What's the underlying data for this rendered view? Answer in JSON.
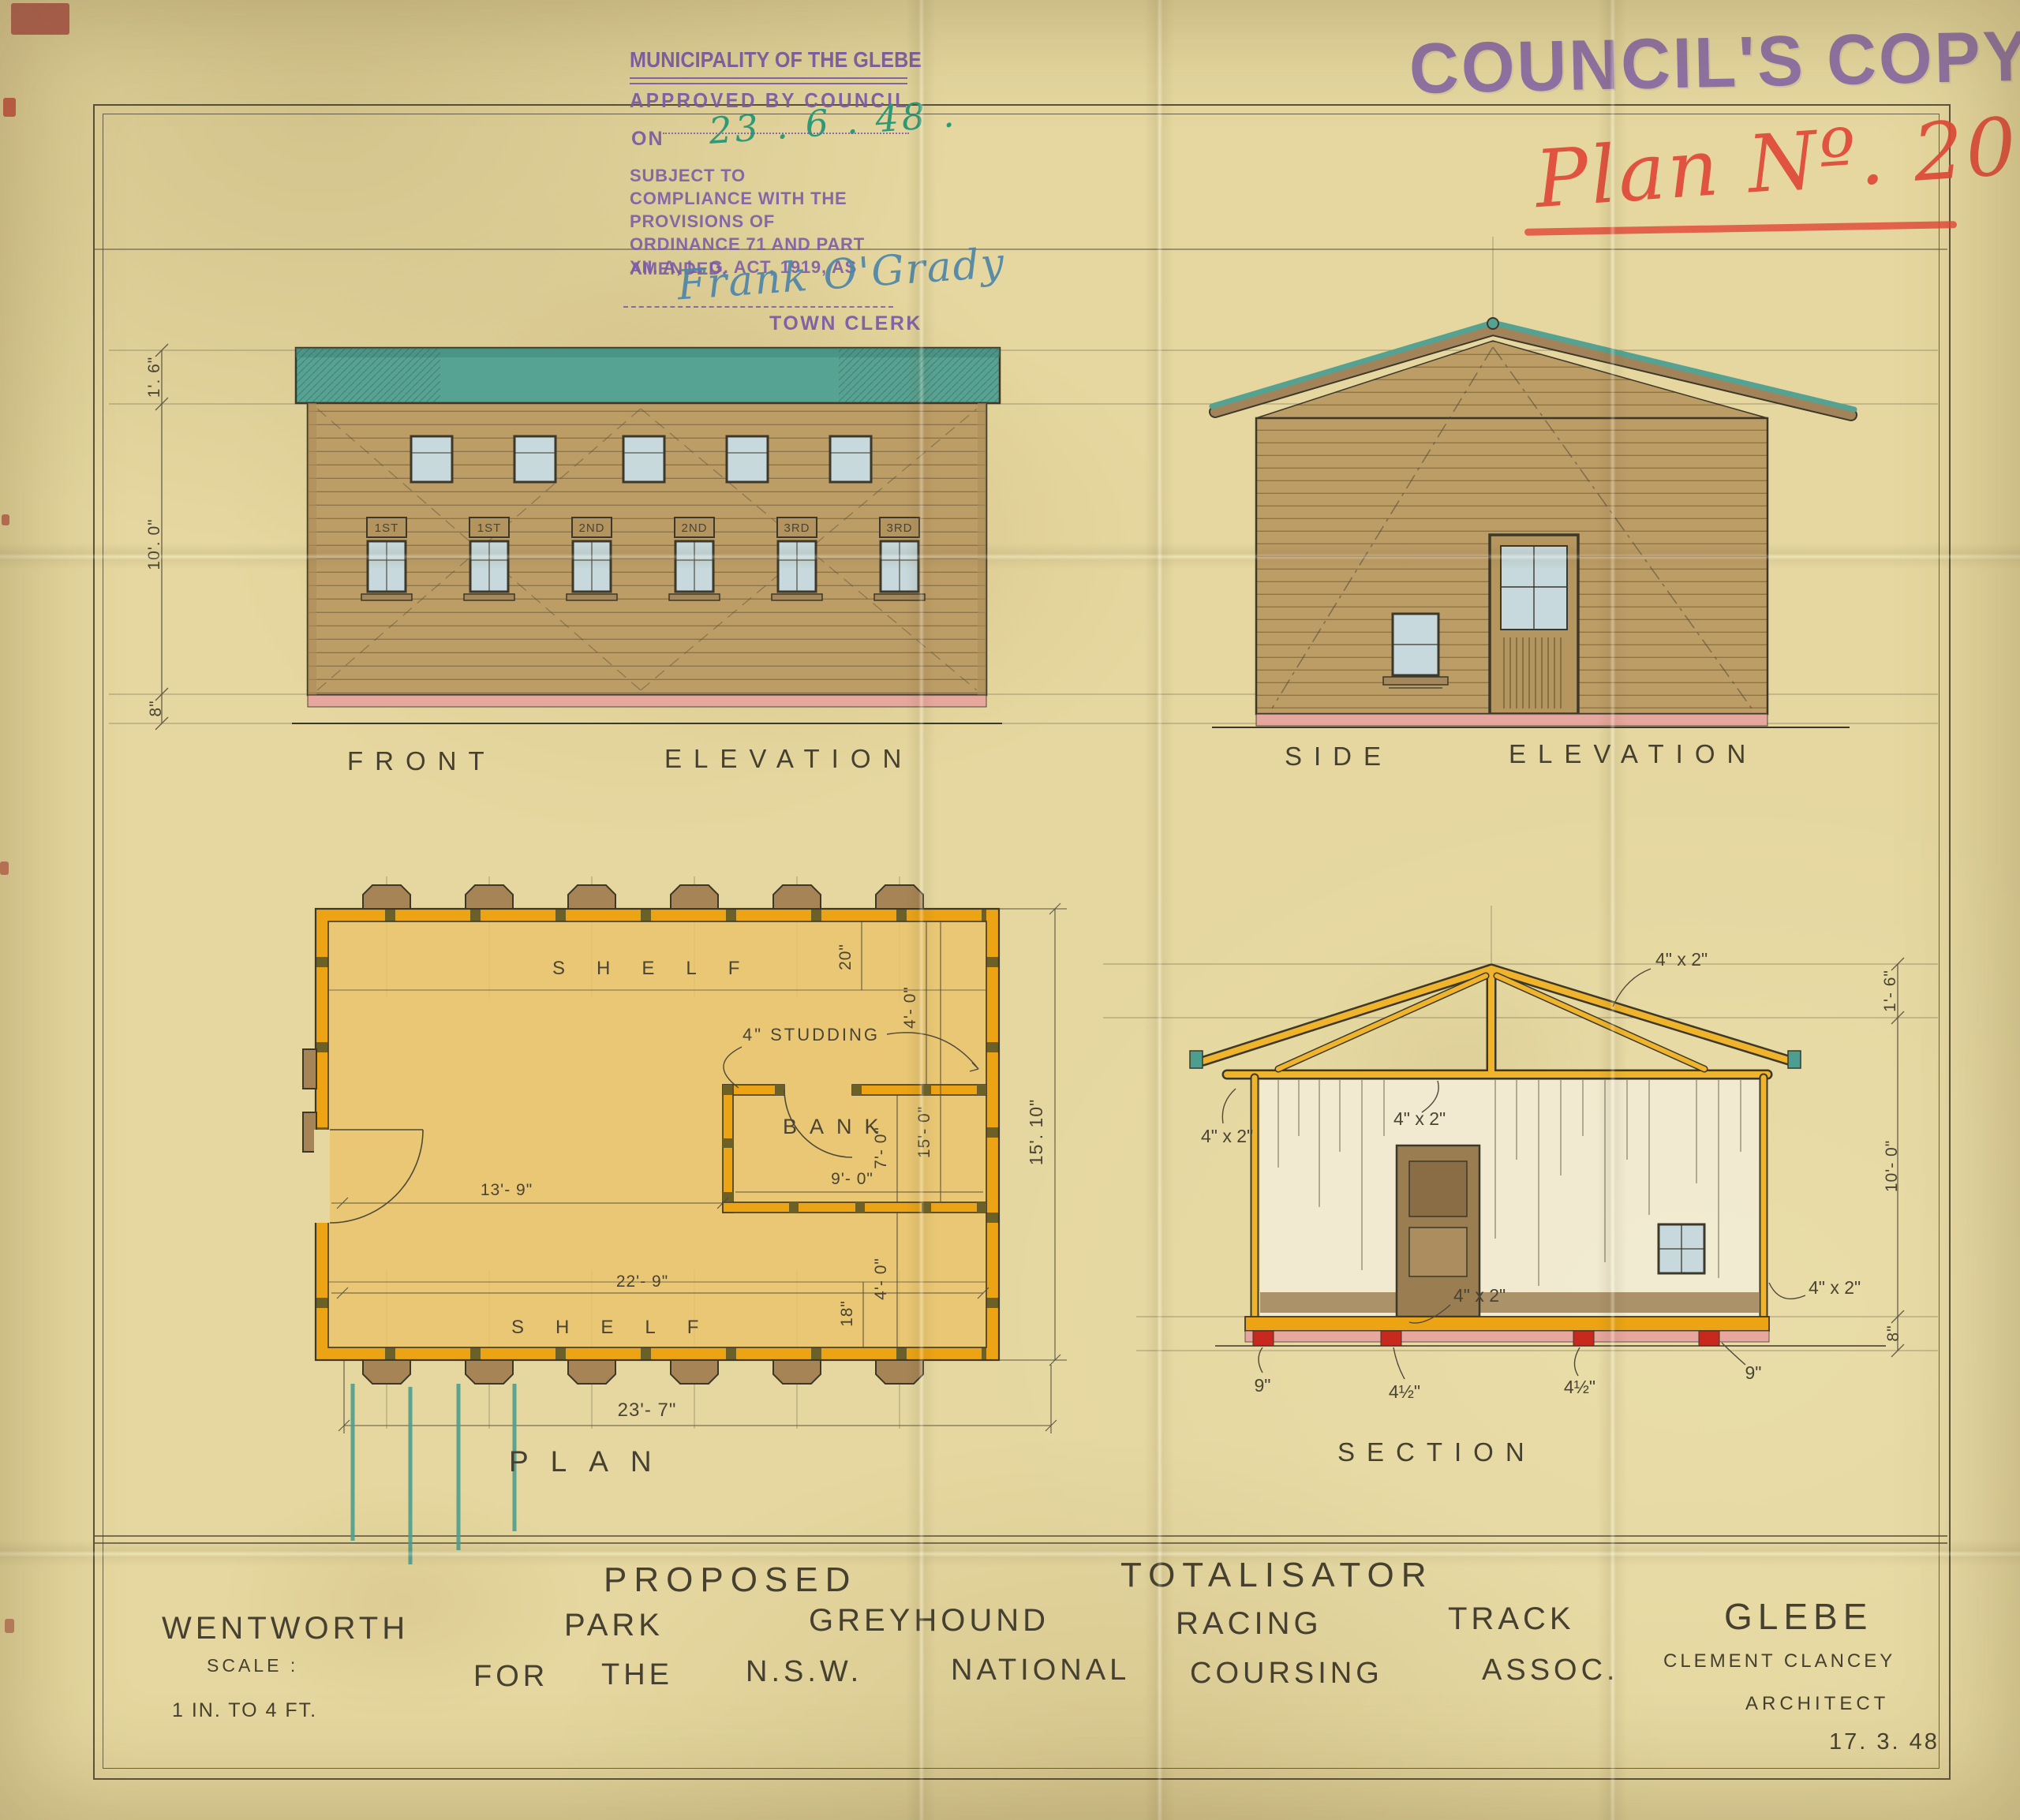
{
  "stamps": {
    "municipality": {
      "authority": "MUNICIPALITY OF THE GLEBE",
      "approved": "APPROVED BY COUNCIL",
      "on_label": "ON",
      "approval_date": "23 . 6 . 48 .",
      "conditions": "SUBJECT TO COMPLIANCE WITH THE PROVISIONS OF ORDINANCE 71 AND PART XII. A, L. G. ACT, 1919, AS",
      "amended": "AMENDED.",
      "signature": "Frank O'Grady",
      "signatory_title": "TOWN CLERK"
    },
    "councils_copy": "COUNCIL'S COPY.",
    "plan_number": "Plan Nº. 20"
  },
  "front_elevation": {
    "caption_a": "FRONT",
    "caption_b": "ELEVATION",
    "window_signs": [
      "1ST",
      "1ST",
      "2ND",
      "2ND",
      "3RD",
      "3RD"
    ],
    "dim_roof": "1'. 6\"",
    "dim_wall": "10'. 0\"",
    "dim_base": "8\""
  },
  "side_elevation": {
    "caption_a": "SIDE",
    "caption_b": "ELEVATION"
  },
  "plan": {
    "caption": "PLAN",
    "shelf_top": "SHELF",
    "shelf_bottom": "SHELF",
    "studding_note": "4\" STUDDING",
    "room_label": "BANK",
    "dim_shelf_top": "20\"",
    "dim_top_right": "4'- 0\"",
    "dim_bank_width": "9'- 0\"",
    "dim_bank_depth": "7'- 0\"",
    "dim_inner_depth": "15'- 0\"",
    "dim_bank_offset": "4'- 0\"",
    "dim_left_room": "13'- 9\"",
    "dim_inner_width": "22'- 9\"",
    "dim_shelf_bottom": "18\"",
    "dim_overall_width": "23'- 7\"",
    "dim_overall_depth": "15'. 10\""
  },
  "section": {
    "caption": "SECTION",
    "timber_note": "4\" x 2\"",
    "dim_pier_left": "9\"",
    "dim_plate_left": "4½\"",
    "dim_plate_right": "4½\"",
    "dim_pier_right": "9\"",
    "dim_roof": "1'- 6\"",
    "dim_wall": "10'- 0\"",
    "dim_base": "8\""
  },
  "title_block": {
    "row1": {
      "w1": "PROPOSED",
      "w2": "TOTALISATOR"
    },
    "row2": {
      "w1": "WENTWORTH",
      "w2": "PARK",
      "w3": "GREYHOUND",
      "w4": "RACING",
      "w5": "TRACK",
      "w6": "GLEBE"
    },
    "row3": {
      "w1": "FOR",
      "w2": "THE",
      "w3": "N.S.W.",
      "w4": "NATIONAL",
      "w5": "COURSING",
      "w6": "ASSOC."
    },
    "scale_label": "SCALE :",
    "scale_value": "1 IN. TO 4 FT.",
    "architect_name": "CLEMENT CLANCEY",
    "architect_title": "ARCHITECT",
    "date": "17. 3. 48"
  },
  "colors": {
    "paper": "#e5d79f",
    "ink": "#45402f",
    "stamp_purple": "#7a5aa6",
    "crayon_red": "#e04838",
    "ink_green": "#2f9a78",
    "ink_blue": "#4e86a8",
    "wash_timber": "#bd9d66",
    "wash_roof_teal": "#55a292",
    "wash_wall_yellow": "#eca414",
    "wash_floor_pink": "#e7a49e",
    "pier_red": "#c8291f"
  }
}
